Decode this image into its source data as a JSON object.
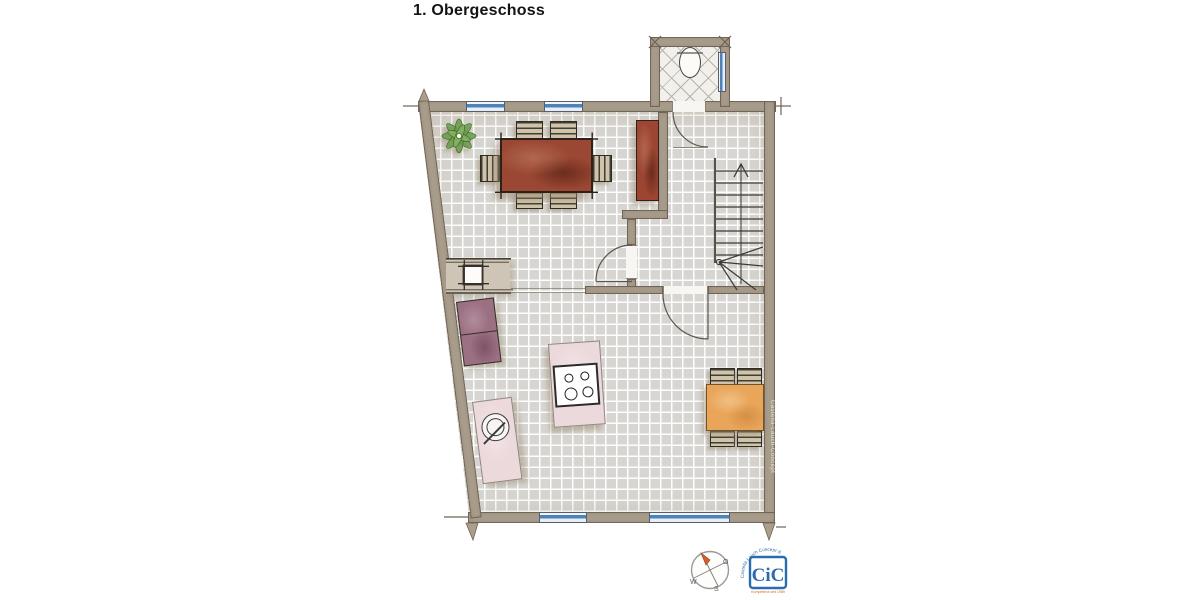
{
  "title": "1. Obergeschoss",
  "watermark": "Castella-Lauch-Concept",
  "compass": {
    "east_label": "O",
    "west_label": "W",
    "south_label": "S"
  },
  "logo": {
    "monogram": "CiC",
    "arc_text": "Castella Lauch Concept ®",
    "tagline": "Kompetenz seit 1989"
  },
  "plan_elements": [
    "wc-room",
    "toilet",
    "staircase",
    "dining-table-6-chairs",
    "sideboard",
    "plant",
    "kitchen-island-with-stove",
    "sink-counter",
    "appliance-block",
    "wall-niche-shaft",
    "square-table-4-chairs",
    "windows",
    "doors"
  ],
  "colors": {
    "wall": "#ab9e8d",
    "floor_tile": "#d7d5d1",
    "wc_floor": "#f2f0ec",
    "window_blue": "#4f82b8",
    "table_wood": "#9a4733",
    "sideboard_wood": "#9b4532",
    "table_orange": "#e9a559",
    "chair_tan": "#cfc4aa",
    "counter_pink": "#ecd9dc",
    "appliance_purple": "#9c7083",
    "plant_green": "#6b9c4d",
    "line_dark": "#3e3b36",
    "logo_blue": "#2a6cb0",
    "logo_orange": "#d2691e",
    "compass_orange": "#d2622a"
  }
}
